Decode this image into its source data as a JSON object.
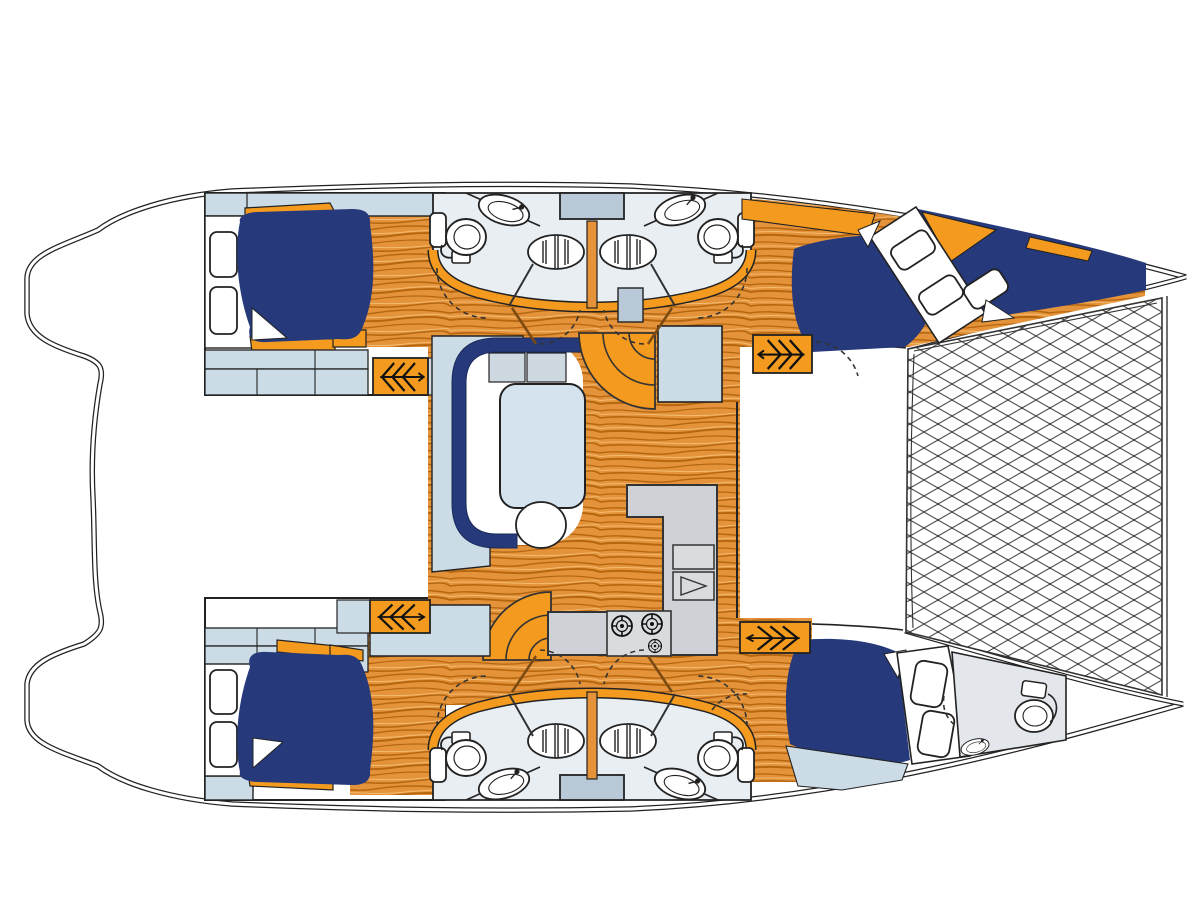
{
  "page": {
    "title": "Catamaran interior layout floor plan",
    "background": "#ffffff"
  },
  "diagram": {
    "type": "yacht-floorplan",
    "orientation": {
      "bow": "right",
      "stern": "left",
      "top_side": "port",
      "bottom_side": "starboard"
    },
    "colors": {
      "line": "#1f1f1f",
      "navy": "#25397b",
      "orange": "#f49b1f",
      "woodBase": "#e5933a",
      "woodGrain": "#b5660f",
      "woodGrainLight": "#f2bb72",
      "lightBlue": "#ccdce7",
      "bathFloor": "#e9eef3",
      "steelBlue": "#b9c9d7",
      "counterGray": "#ced2d6",
      "stoveGray": "#d9dcdf",
      "tableBlue": "#d5e3ee",
      "cushion": "#cdd8e1",
      "bowHeadFloor": "#e3e7eb",
      "netLine": "#4a4a4a",
      "doorBrown": "#7a4a12",
      "white": "#ffffff"
    },
    "rooms": [
      {
        "id": "salon",
        "label": "salon-dinette"
      },
      {
        "id": "galley",
        "label": "galley"
      },
      {
        "id": "nav-station",
        "label": "nav-station"
      },
      {
        "id": "port-aft-cabin",
        "label": "port-aft-double-cabin"
      },
      {
        "id": "port-forward-cabin",
        "label": "port-forward-double-cabin"
      },
      {
        "id": "starboard-aft-cabin",
        "label": "starboard-aft-double-cabin"
      },
      {
        "id": "starboard-forward-cabin",
        "label": "starboard-forward-double-cabin"
      },
      {
        "id": "port-aft-head",
        "label": "port-aft-head-with-shower"
      },
      {
        "id": "port-forward-head",
        "label": "port-forward-head-with-shower"
      },
      {
        "id": "starboard-aft-head",
        "label": "starboard-aft-head-with-shower"
      },
      {
        "id": "starboard-forward-head",
        "label": "starboard-forward-head-with-shower"
      },
      {
        "id": "forepeak-head",
        "label": "starboard-bow-wc"
      },
      {
        "id": "trampoline",
        "label": "bow-trampoline-net"
      },
      {
        "id": "aft-deck",
        "label": "aft-deck"
      }
    ],
    "furniture_counts": {
      "double_berths": 4,
      "toilets": 5,
      "sinks": 5,
      "shower_grates": 4,
      "companionway_steps": 4,
      "stove_burners": 3,
      "deck_hatches": 9
    }
  }
}
